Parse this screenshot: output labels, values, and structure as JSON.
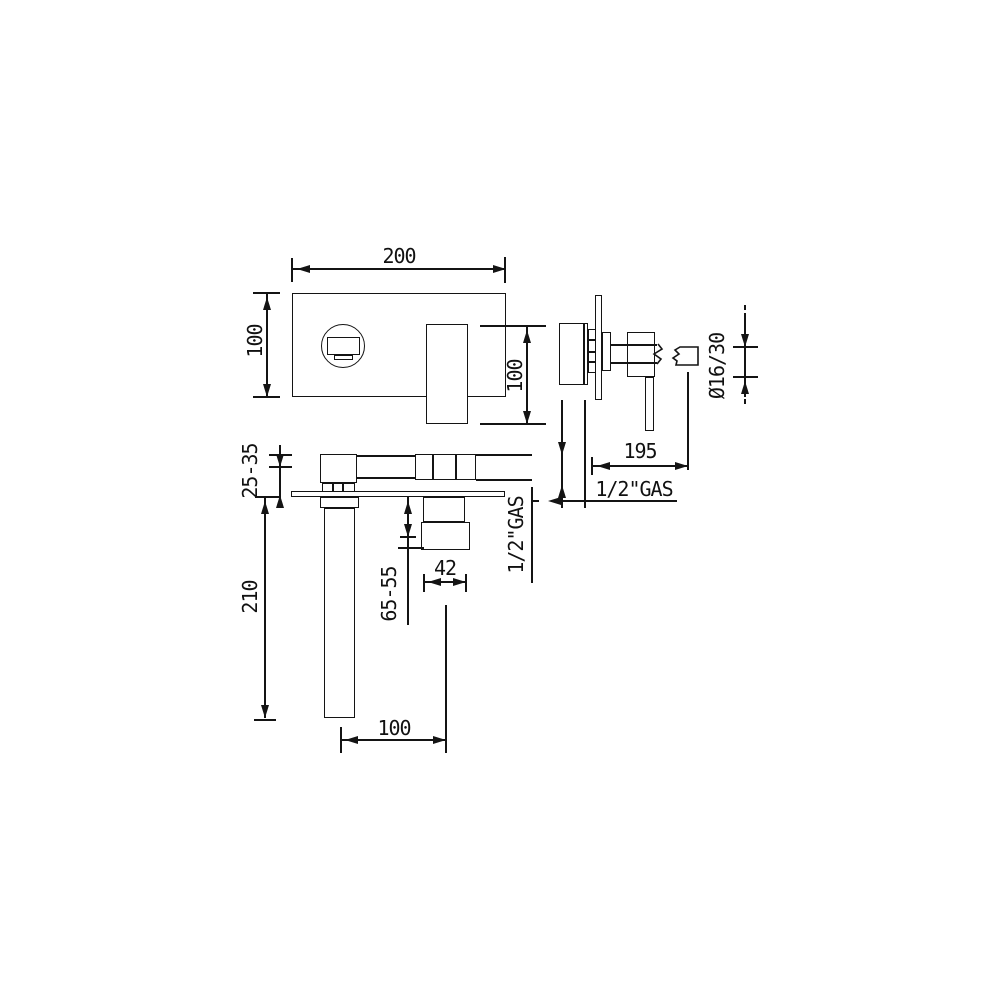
{
  "document": {
    "kind": "faucet installation technical drawing",
    "background_color": "#ffffff",
    "line_color": "#141414"
  },
  "views": {
    "front": {
      "plate_width_label": "200",
      "plate_height_label": "100",
      "handle_height_label": "100"
    },
    "side": {
      "spout_reach_label": "195",
      "spout_section_label": "Ø16/30",
      "supply_thread_label": "1/2\"GAS"
    },
    "installation": {
      "plaster_range_label": "25-35",
      "spout_drop_label": "210",
      "body_depth_label": "65-55",
      "body_width_label": "42",
      "axis_distance_label": "100",
      "supply_thread_label": "1/2\"GAS"
    }
  }
}
